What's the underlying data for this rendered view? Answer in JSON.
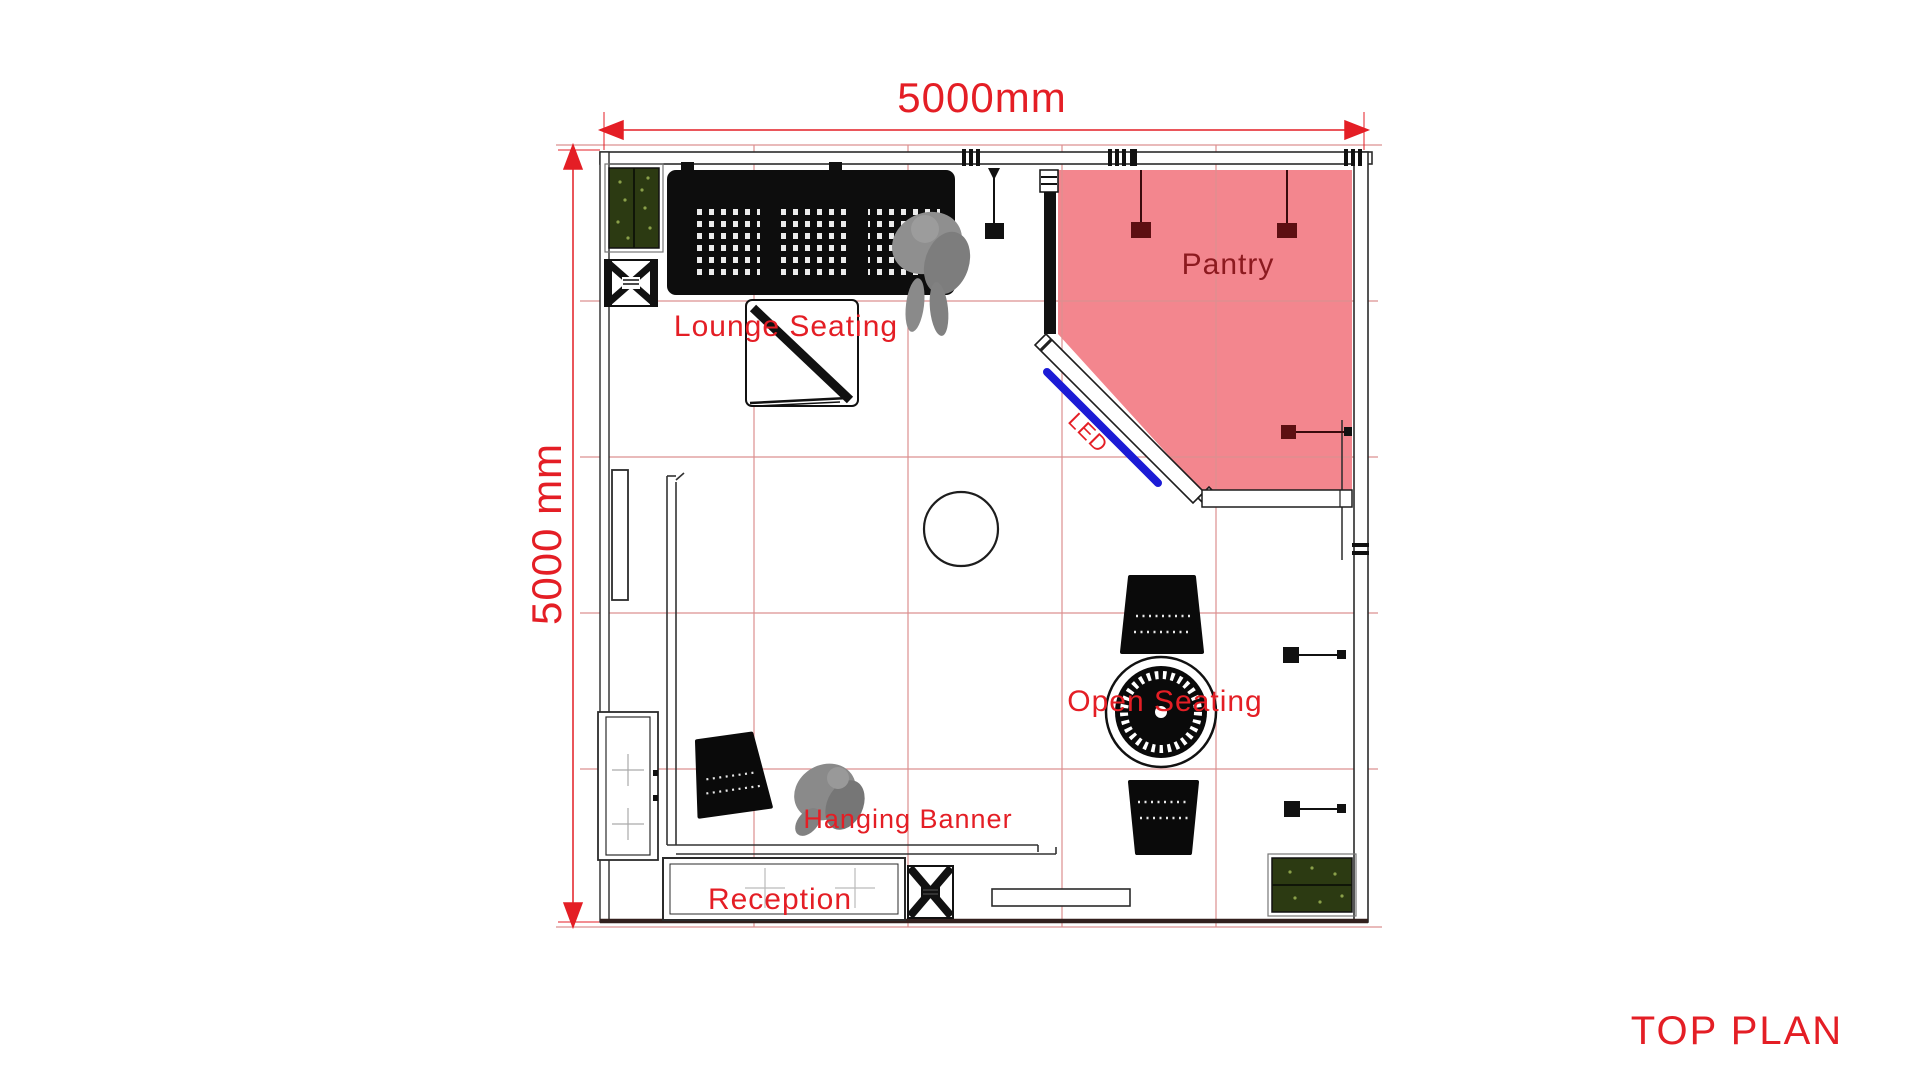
{
  "title": "TOP PLAN",
  "dimensions": {
    "width": "5000mm",
    "height": "5000 mm"
  },
  "areas": {
    "pantry": "Pantry",
    "lounge_seating": "Lounge Seating",
    "led": "LED",
    "open_seating": "Open Seating",
    "hanging_banner": "Hanging Banner",
    "reception": "Reception"
  },
  "colors": {
    "accent_red": "#e41e25",
    "pantry_fill": "#f3868e",
    "pantry_label": "#8c1a1f",
    "led_blue": "#1b1bd6",
    "grid_red": "#dc9090",
    "hedge_green": "#2c3a12"
  }
}
